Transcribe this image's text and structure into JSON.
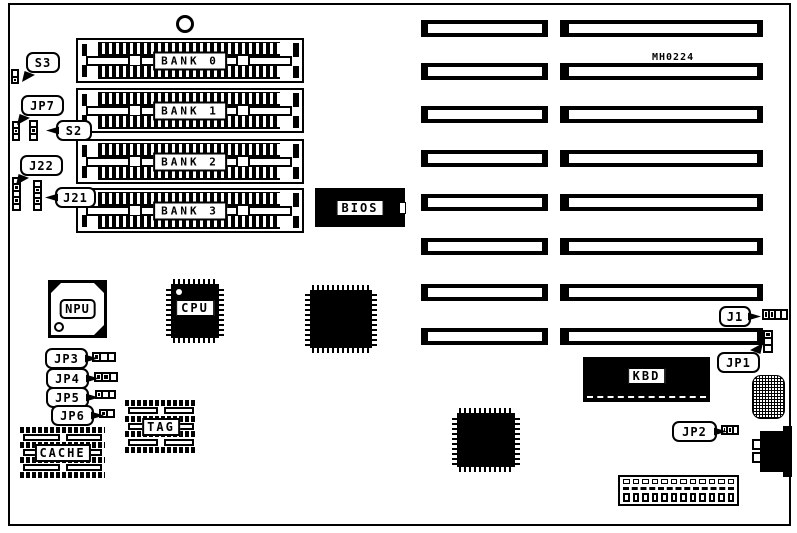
{
  "board": {
    "code": "MH0224",
    "ink": "#000000",
    "paper": "#ffffff"
  },
  "memory_banks": {
    "x": 76,
    "w": 228,
    "h": 45,
    "items": [
      {
        "label": "BANK 0",
        "y": 38
      },
      {
        "label": "BANK 1",
        "y": 88
      },
      {
        "label": "BANK 2",
        "y": 139
      },
      {
        "label": "BANK 3",
        "y": 188
      }
    ]
  },
  "expansion_slots": {
    "rows_y": [
      20,
      63,
      106,
      150,
      194,
      238,
      284,
      328
    ],
    "h": 17,
    "left_column": {
      "x": 421,
      "w": 127,
      "inner_left": 7,
      "inner_right": 6
    },
    "right_column": {
      "x": 560,
      "w": 203,
      "inner_left": 9,
      "inner_right": 6
    }
  },
  "chips": {
    "bios": {
      "label": "BIOS"
    },
    "kbd": {
      "label": "KBD"
    },
    "npu": {
      "label": "NPU"
    },
    "cpu": {
      "label": "CPU"
    },
    "cache": {
      "label": "CACHE"
    },
    "tag": {
      "label": "TAG"
    }
  },
  "callouts": [
    {
      "label": "S3"
    },
    {
      "label": "JP7"
    },
    {
      "label": "S2"
    },
    {
      "label": "J22"
    },
    {
      "label": "J21"
    },
    {
      "label": "JP3"
    },
    {
      "label": "JP4"
    },
    {
      "label": "JP5"
    },
    {
      "label": "JP6"
    },
    {
      "label": "J1"
    },
    {
      "label": "JP1"
    },
    {
      "label": "JP2"
    }
  ],
  "jumpers": [
    {
      "name": "s3-jumper",
      "x": 11,
      "y": 69,
      "w": 8,
      "h": 15,
      "dir": "v",
      "cells": 2,
      "filled": [
        1
      ]
    },
    {
      "name": "jp7-jumper",
      "x": 12,
      "y": 121,
      "w": 8,
      "h": 20,
      "dir": "v",
      "cells": 3,
      "filled": [
        1
      ]
    },
    {
      "name": "s2-jumper",
      "x": 29,
      "y": 120,
      "w": 9,
      "h": 21,
      "dir": "v",
      "cells": 3,
      "filled": [
        1
      ]
    },
    {
      "name": "j22-connector",
      "x": 12,
      "y": 177,
      "w": 9,
      "h": 34,
      "dir": "v",
      "cells": 5,
      "filled": [
        1,
        3
      ]
    },
    {
      "name": "j21-connector",
      "x": 33,
      "y": 180,
      "w": 9,
      "h": 31,
      "dir": "v",
      "cells": 5,
      "filled": [
        1,
        3
      ]
    },
    {
      "name": "jp3-jumper",
      "x": 92,
      "y": 352,
      "w": 24,
      "h": 10,
      "dir": "h",
      "cells": 3,
      "filled": [
        0
      ]
    },
    {
      "name": "jp4-jumper",
      "x": 94,
      "y": 372,
      "w": 24,
      "h": 10,
      "dir": "h",
      "cells": 3,
      "filled": [
        0,
        1
      ]
    },
    {
      "name": "jp5-jumper",
      "x": 95,
      "y": 390,
      "w": 21,
      "h": 9,
      "dir": "h",
      "cells": 3,
      "filled": [
        0
      ]
    },
    {
      "name": "jp6-jumper",
      "x": 99,
      "y": 409,
      "w": 16,
      "h": 9,
      "dir": "h",
      "cells": 2,
      "filled": [
        0
      ]
    },
    {
      "name": "j1-jumper",
      "x": 762,
      "y": 309,
      "w": 26,
      "h": 11,
      "dir": "h",
      "cells": 4,
      "filled": [
        0,
        1
      ]
    },
    {
      "name": "jp1-jumper",
      "x": 763,
      "y": 330,
      "w": 10,
      "h": 23,
      "dir": "v",
      "cells": 3,
      "filled": [
        0
      ]
    },
    {
      "name": "jp2-jumper",
      "x": 721,
      "y": 425,
      "w": 18,
      "h": 10,
      "dir": "h",
      "cells": 3,
      "filled": [
        0,
        1
      ]
    }
  ],
  "dip_banks": {
    "rows": 7
  },
  "power_connector": {
    "tabs": 12,
    "pins": 12
  }
}
